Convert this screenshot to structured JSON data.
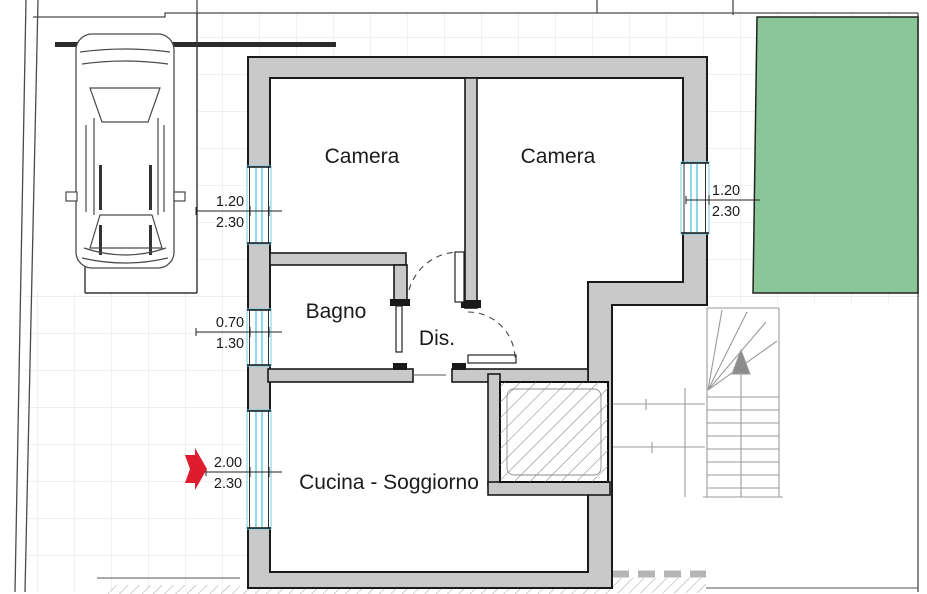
{
  "plan_title": "Floor plan",
  "rooms": [
    {
      "id": "camera-left",
      "label": "Camera"
    },
    {
      "id": "camera-right",
      "label": "Camera"
    },
    {
      "id": "bagno",
      "label": "Bagno"
    },
    {
      "id": "dis",
      "label": "Dis."
    },
    {
      "id": "cucina-soggiorno",
      "label": "Cucina - Soggiorno"
    }
  ],
  "openings": [
    {
      "id": "window-camera-left",
      "width_m": "1.20",
      "height_m": "2.30",
      "side": "left"
    },
    {
      "id": "window-bagno",
      "width_m": "0.70",
      "height_m": "1.30",
      "side": "left"
    },
    {
      "id": "entrance-door",
      "width_m": "2.00",
      "height_m": "2.30",
      "side": "left"
    },
    {
      "id": "window-camera-right",
      "width_m": "1.20",
      "height_m": "2.30",
      "side": "right"
    }
  ],
  "colors": {
    "wall_fill": "#c9c9c9",
    "wall_outline": "#1a1a1a",
    "window_glass": "#6fd0e6",
    "garden_green": "#8bc698",
    "entrance_arrow_red": "#df1b2e",
    "stair_line_gray": "#9b9b9b",
    "stair_arrow_gray": "#8c8c8c",
    "grid_line": "#e6e0dd"
  }
}
